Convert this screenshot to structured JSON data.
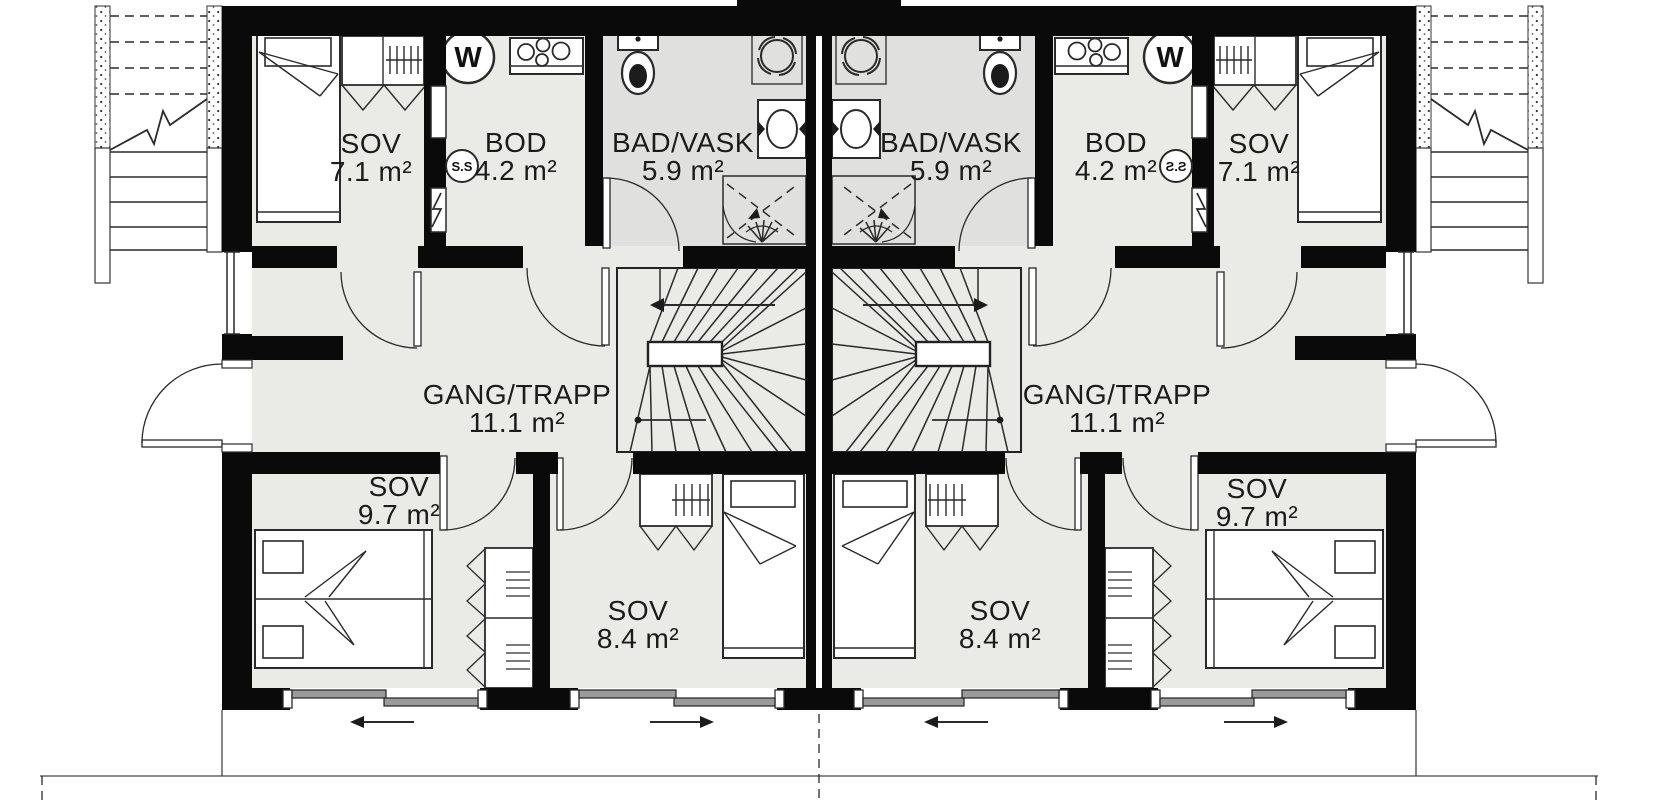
{
  "plan": {
    "units": [
      {
        "side": "left",
        "rooms": [
          {
            "name": "SOV",
            "area": "7.1 m²"
          },
          {
            "name": "BOD",
            "area": "4.2 m²"
          },
          {
            "name": "BAD/VASK",
            "area": "5.9 m²"
          },
          {
            "name": "GANG/TRAPP",
            "area": "11.1 m²"
          },
          {
            "name": "SOV",
            "area": "9.7 m²"
          },
          {
            "name": "SOV",
            "area": "8.4 m²"
          }
        ]
      },
      {
        "side": "right",
        "rooms": [
          {
            "name": "SOV",
            "area": "7.1 m²"
          },
          {
            "name": "BOD",
            "area": "4.2 m²"
          },
          {
            "name": "BAD/VASK",
            "area": "5.9 m²"
          },
          {
            "name": "GANG/TRAPP",
            "area": "11.1 m²"
          },
          {
            "name": "SOV",
            "area": "9.7 m²"
          },
          {
            "name": "SOV",
            "area": "8.4 m²"
          }
        ]
      }
    ],
    "appliance_labels": {
      "washing_machine": "W",
      "fuse_box": "S.S"
    },
    "colors": {
      "wall": "#0a0a0a",
      "floor": "#eaeae7",
      "bathroom_floor": "#e0e1de",
      "line": "#2a2a2a",
      "panel_gray": "#9b9b9b",
      "background": "#ffffff"
    }
  }
}
